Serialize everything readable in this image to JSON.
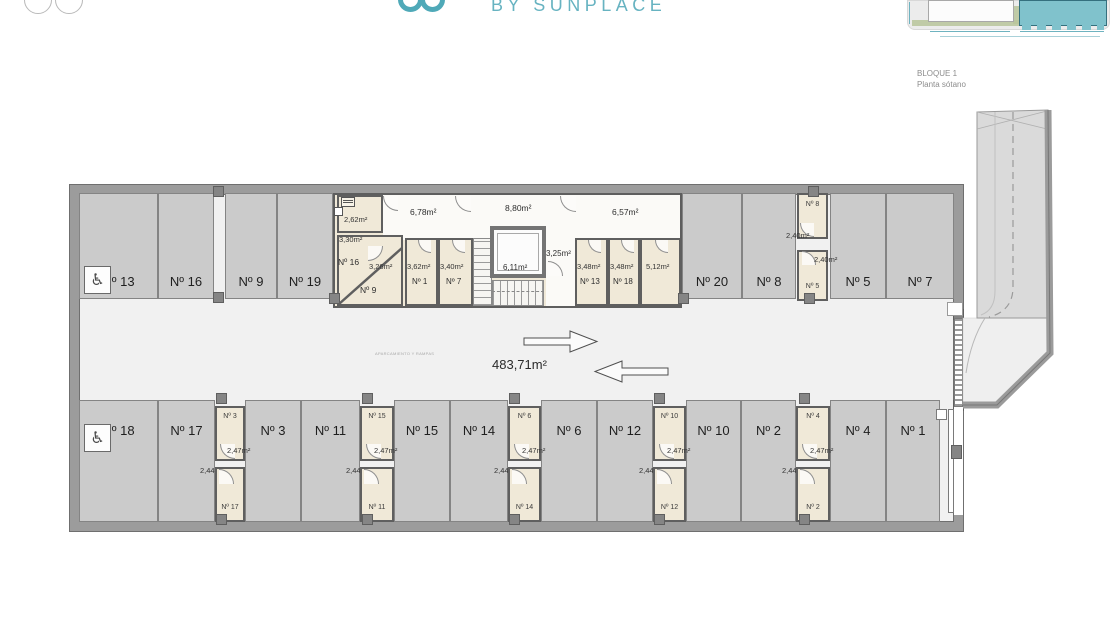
{
  "header": {
    "brand": "BY SUNPLACE"
  },
  "minimap": {
    "block_label": "BLOQUE 1",
    "floor_label": "Planta sótano"
  },
  "colors": {
    "accent_teal": "#4fa9b8",
    "stall_fill": "#cbcbcb",
    "storage_fill": "#f0e9d8",
    "wall_gray": "#9c9c9c"
  },
  "icons": {
    "wheelchair": "♿"
  },
  "aisle": {
    "total_area": "483,71m²",
    "note": "APARCAMIENTO Y RAMPAS"
  },
  "parking_top": [
    {
      "label": "Nº 13"
    },
    {
      "label": "Nº 16"
    },
    {
      "label": "Nº 9"
    },
    {
      "label": "Nº 19"
    },
    {
      "label": "Nº 20"
    },
    {
      "label": "Nº 8"
    },
    {
      "label": "Nº 5"
    },
    {
      "label": "Nº 7"
    }
  ],
  "parking_bottom": [
    {
      "label": "Nº 18"
    },
    {
      "label": "Nº 17"
    },
    {
      "label": "Nº 3"
    },
    {
      "label": "Nº 11"
    },
    {
      "label": "Nº 15"
    },
    {
      "label": "Nº 14"
    },
    {
      "label": "Nº 6"
    },
    {
      "label": "Nº 12"
    },
    {
      "label": "Nº 10"
    },
    {
      "label": "Nº 2"
    },
    {
      "label": "Nº 4"
    },
    {
      "label": "Nº 1"
    }
  ],
  "core": {
    "room_262": "2,62m²",
    "room_330": "3,30m²",
    "id_16": "Nº 16",
    "area_326": "3,26m²",
    "id_9": "Nº 9",
    "corridor_678": "6,78m²",
    "area_362": "3,62m²",
    "id_1": "Nº 1",
    "area_340": "3,40m²",
    "id_7": "Nº 7",
    "corridor_880": "8,80m²",
    "elevator_area": "6,11m²",
    "landing_area": "3,25m²",
    "corridor_657": "6,57m²",
    "area_348a": "3,48m²",
    "id_13": "Nº 13",
    "area_348b": "3,48m²",
    "id_18": "Nº 18",
    "area_512": "5,12m²"
  },
  "storage_right": {
    "top_id": "Nº 8",
    "top_area": "2,40m²",
    "bottom_id": "Nº 5",
    "bottom_area": "2,40m²"
  },
  "storage_cols": [
    {
      "top_id": "Nº 3",
      "top_area": "2,47m²",
      "bottom_area": "2,44m²",
      "bottom_id": "Nº 17"
    },
    {
      "top_id": "Nº 15",
      "top_area": "2,47m²",
      "bottom_area": "2,44m²",
      "bottom_id": "Nº 11"
    },
    {
      "top_id": "Nº 6",
      "top_area": "2,47m²",
      "bottom_area": "2,44m²",
      "bottom_id": "Nº 14"
    },
    {
      "top_id": "Nº 10",
      "top_area": "2,47m²",
      "bottom_area": "2,44m²",
      "bottom_id": "Nº 12"
    },
    {
      "top_id": "Nº 4",
      "top_area": "2,47m²",
      "bottom_area": "2,44m²",
      "bottom_id": "Nº 2"
    }
  ]
}
